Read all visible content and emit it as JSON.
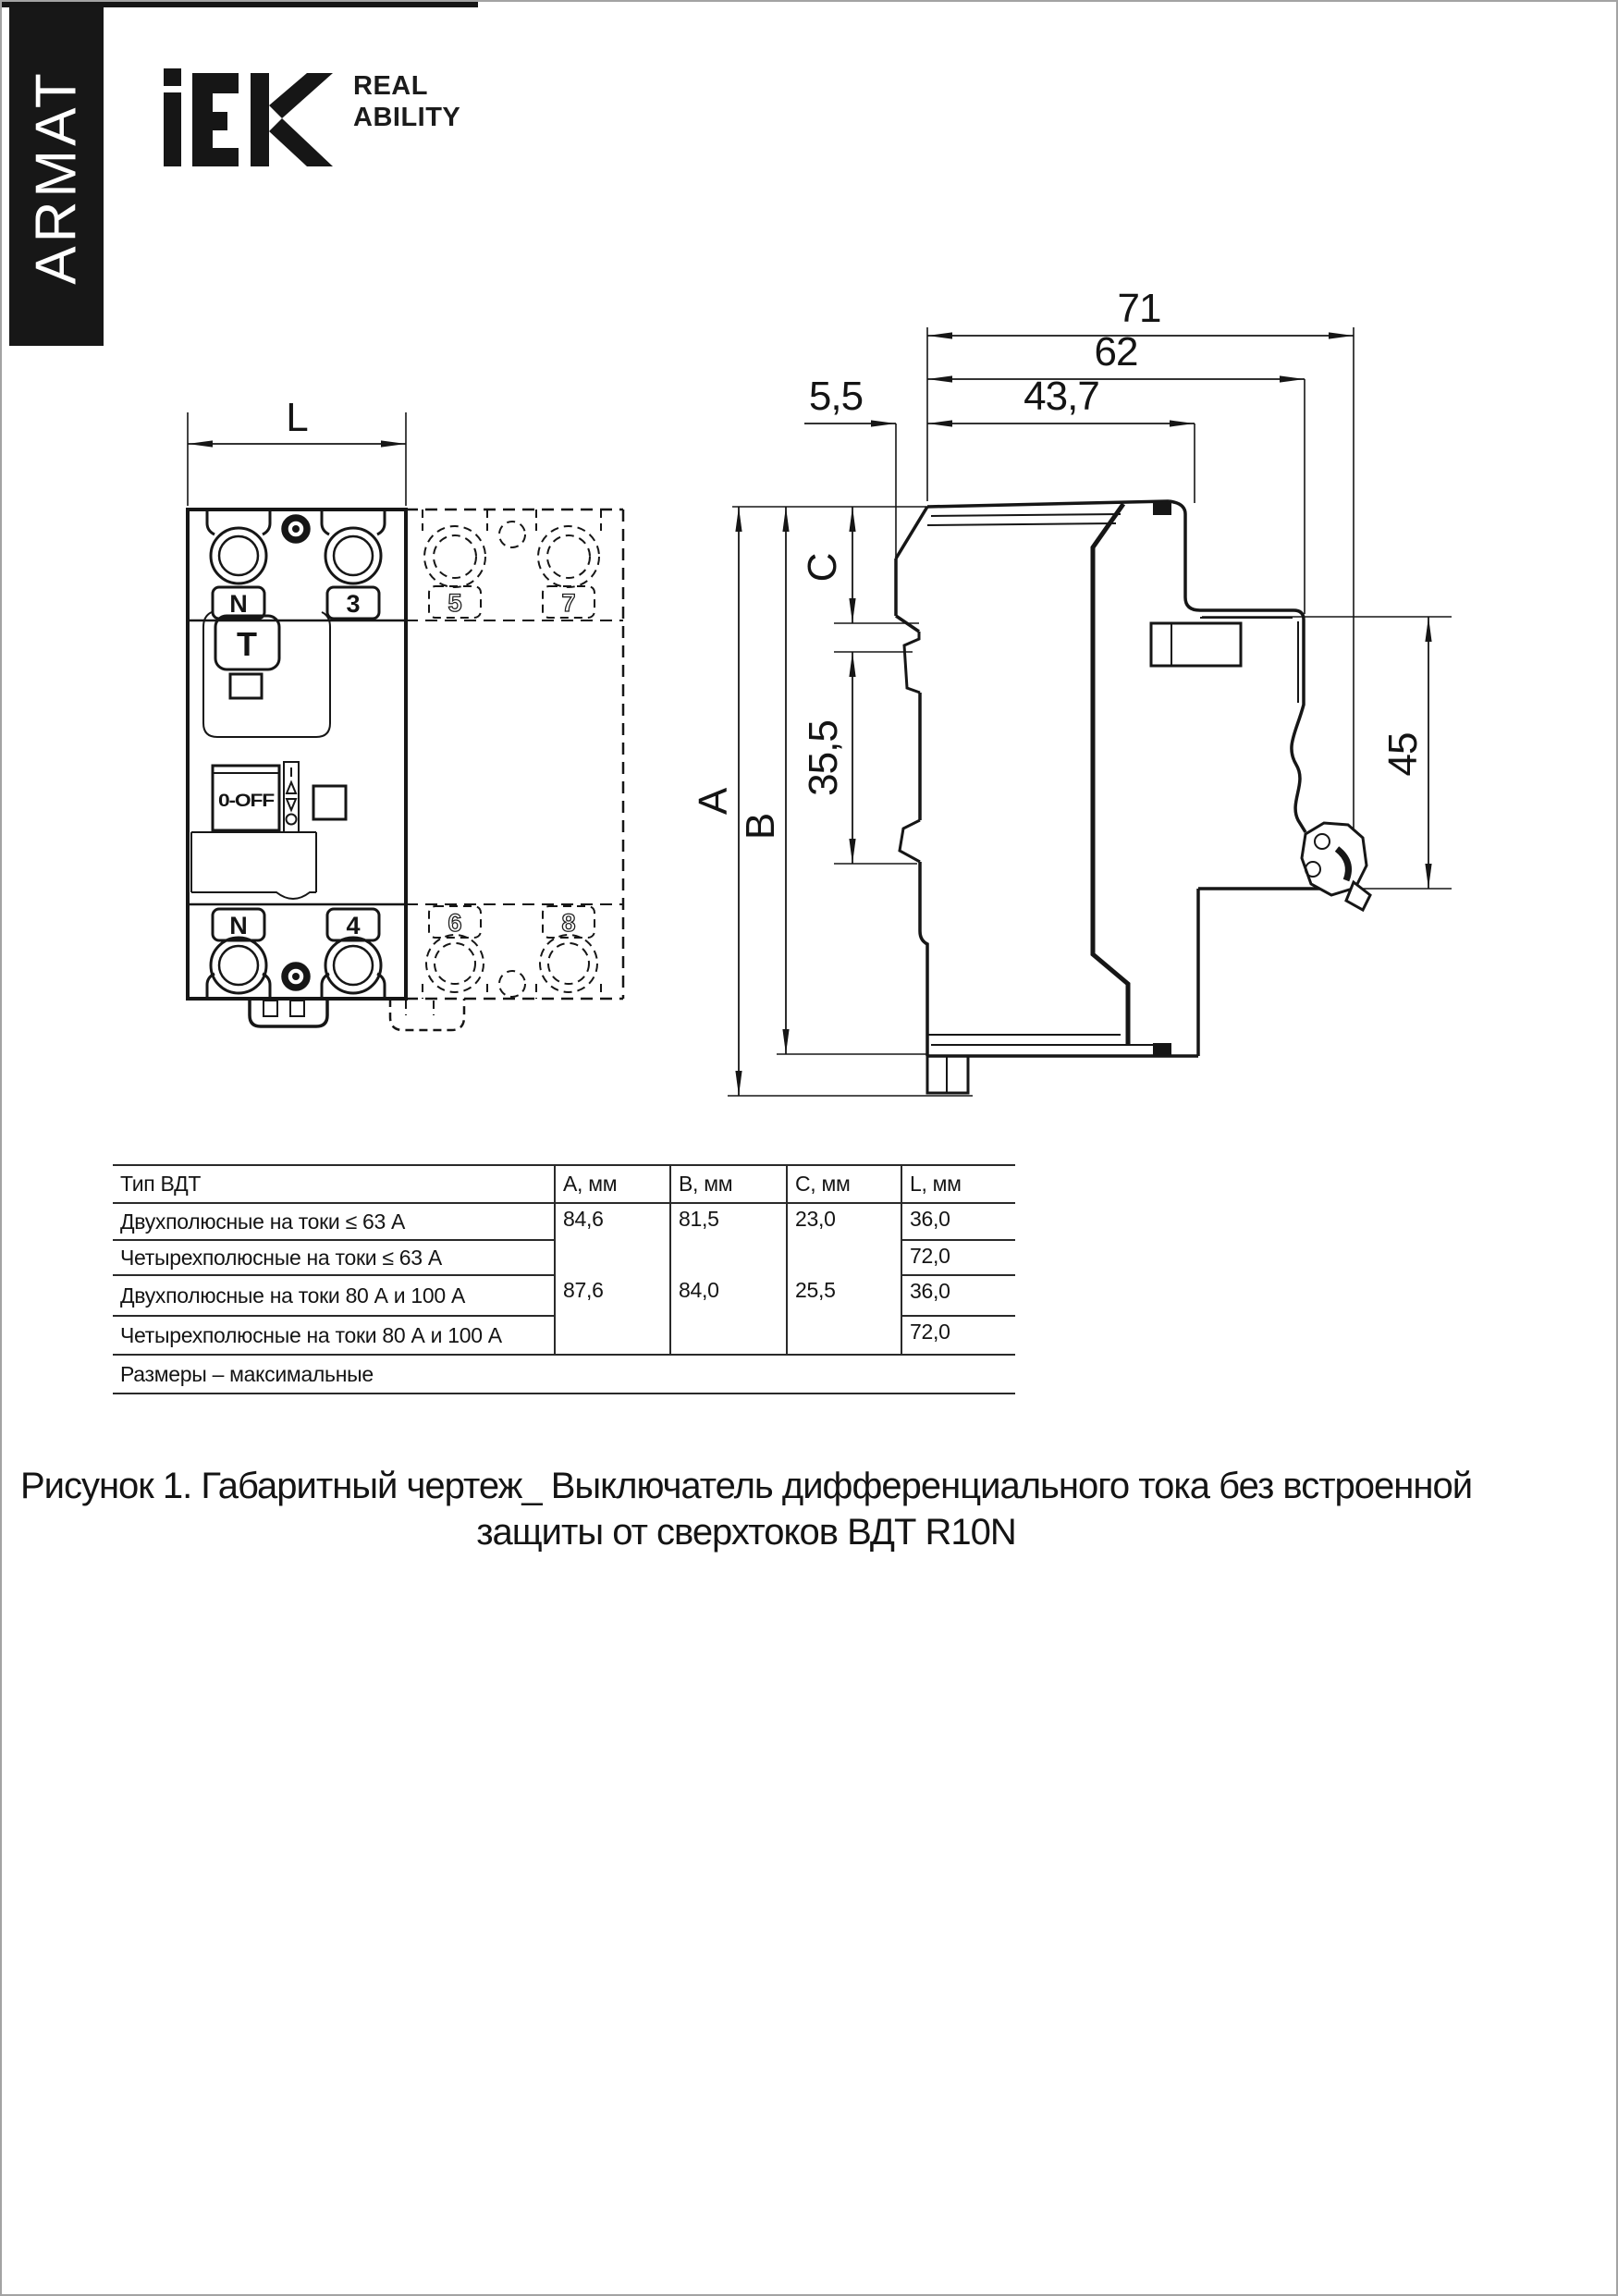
{
  "brand": {
    "banner": "ARMAT",
    "logo_text": "iEK",
    "tagline": [
      "REAL",
      "ABILITY"
    ]
  },
  "front_view": {
    "dim_width": "L",
    "top_terminals": [
      "N",
      "3"
    ],
    "top_terminals_dashed": [
      "5",
      "7"
    ],
    "bottom_terminals": [
      "N",
      "4"
    ],
    "bottom_terminals_dashed": [
      "6",
      "8"
    ],
    "test_button": "Т",
    "switch": "0-OFF"
  },
  "side_view": {
    "dims": {
      "total": "71",
      "width62": "62",
      "offset": "5,5",
      "front": "43,7",
      "a": "A",
      "b": "B",
      "c": "C",
      "mid": "35,5",
      "rail": "45"
    }
  },
  "table": {
    "col_headers": [
      "Тип ВДТ",
      "А, мм",
      "В, мм",
      "С, мм",
      "L, мм"
    ],
    "rows": [
      {
        "type": "Двухполюсные на токи ≤ 63 А",
        "a": "84,6",
        "b": "81,5",
        "c": "23,0",
        "l": "36,0"
      },
      {
        "type": "Четырехполюсные на токи ≤ 63 А",
        "l": "72,0"
      },
      {
        "type": "Двухполюсные на токи 80 А и 100 А",
        "a": "87,6",
        "b": "84,0",
        "c": "25,5",
        "l": "36,0"
      },
      {
        "type": "Четырехполюсные на токи 80 А и 100 А",
        "l": "72,0"
      }
    ],
    "footnote": "Размеры – максимальные"
  },
  "caption": {
    "line1": "Рисунок 1. Габаритный чертеж_ Выключатель дифференциального тока без встроенной",
    "line2": "защиты от сверхтоков ВДТ R10N"
  }
}
